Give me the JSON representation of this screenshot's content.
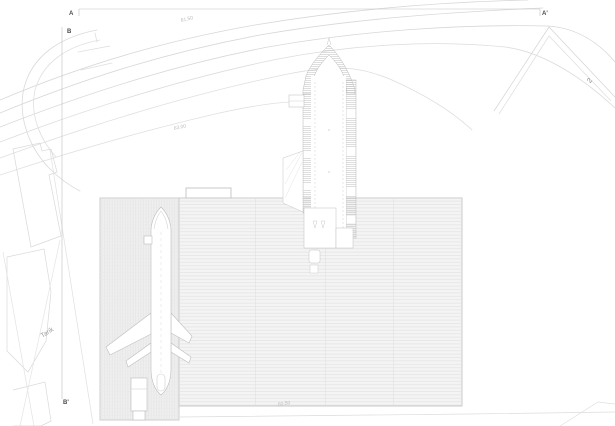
{
  "drawing": {
    "kind": "architectural site plan",
    "markers": {
      "section_a": "A",
      "section_a_prime": "A'",
      "section_b": "B",
      "section_b_prime": "B'"
    },
    "labels": {
      "road_name": "Tarik",
      "parcel_number": "2"
    },
    "elevations": {
      "upper_road": "81.50",
      "middle_road": "63.00",
      "lower_edge": "60.50"
    },
    "colors": {
      "background": "#ffffff",
      "road_line": "#d7d7d7",
      "parcel_line": "#d9d9d9",
      "building_outline": "#b9b9b9",
      "roof_fill": "#f4f4f4",
      "roof_hatch_line": "#e2e2e2",
      "plaza_fill": "#efefef",
      "section_line": "#c2c2c2",
      "marker_text": "#4a4a4a",
      "elevation_text": "#bdbdbd",
      "road_name_text": "#9a9a9a"
    }
  }
}
